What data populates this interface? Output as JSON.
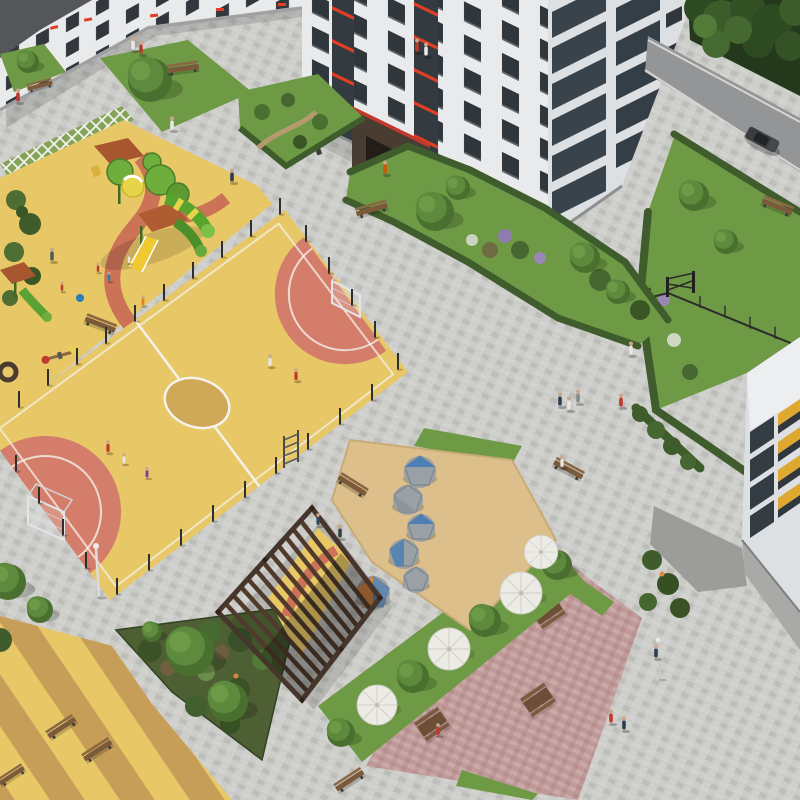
{
  "scene": {
    "title": "Aerial 3D render of a residential courtyard with playground, mini football pitch, pergola and picnic plaza",
    "type": "3d-architectural-render",
    "people_count": 31,
    "vehicles": 1
  },
  "palette": {
    "pavement": "#cbcbc8",
    "asphalt": "#939596",
    "play_yellow": "#e7c766",
    "stripe_tan": "#c79e57",
    "circle_tan": "#cfa957",
    "court_red": "#d4766b",
    "path_red": "#cb7257",
    "mark_white": "#f4f2ea",
    "lawn": "#6e9a45",
    "hedge": "#3f5c2c",
    "tree": "#5d8a3c",
    "shrub_bed": "#4d5f33",
    "sand": "#dcbf8b",
    "plaza_pink": "#c09a98",
    "facade": "#e9eaec",
    "facade_shade": "#dde0e3",
    "roof": "#55565a",
    "window": "#2f363c",
    "glazing": "#39434b",
    "accent_red": "#e23d25",
    "entrance": "#483c33",
    "pergola": "#5d4533",
    "dome_gray": "#9aa1a6",
    "dome_blue": "#4b7fb5",
    "dome_orange": "#d6884a",
    "umbrella": "#ecebe5",
    "bench": "#7b5a3c",
    "fence": "#2b2b2b",
    "car": "#3a3d40"
  },
  "regions": {
    "courtyard": "Paved courtyard",
    "main_building": "Main apartment building",
    "left_building": "Left apartment wing",
    "right_building": "Apartment tower bottom right",
    "road": "Access road with car",
    "forest": "Tree line",
    "playground": "Children playground with slides",
    "sports_field": "Yellow mini football pitch with red goal zones",
    "sand_area": "Sand play area with climbing domes",
    "pergola": "Wooden pergola",
    "picnic_plaza": "Pink paved picnic plaza",
    "mound_area": "Striped play mounds",
    "lawn": "Lawns and hedges"
  },
  "objects": {
    "benches": 11,
    "picnic_tables": 3,
    "umbrellas": 4,
    "climbing_domes": 6,
    "goals": 2,
    "slides": 3,
    "trees": 24,
    "fence_posts": 30
  }
}
